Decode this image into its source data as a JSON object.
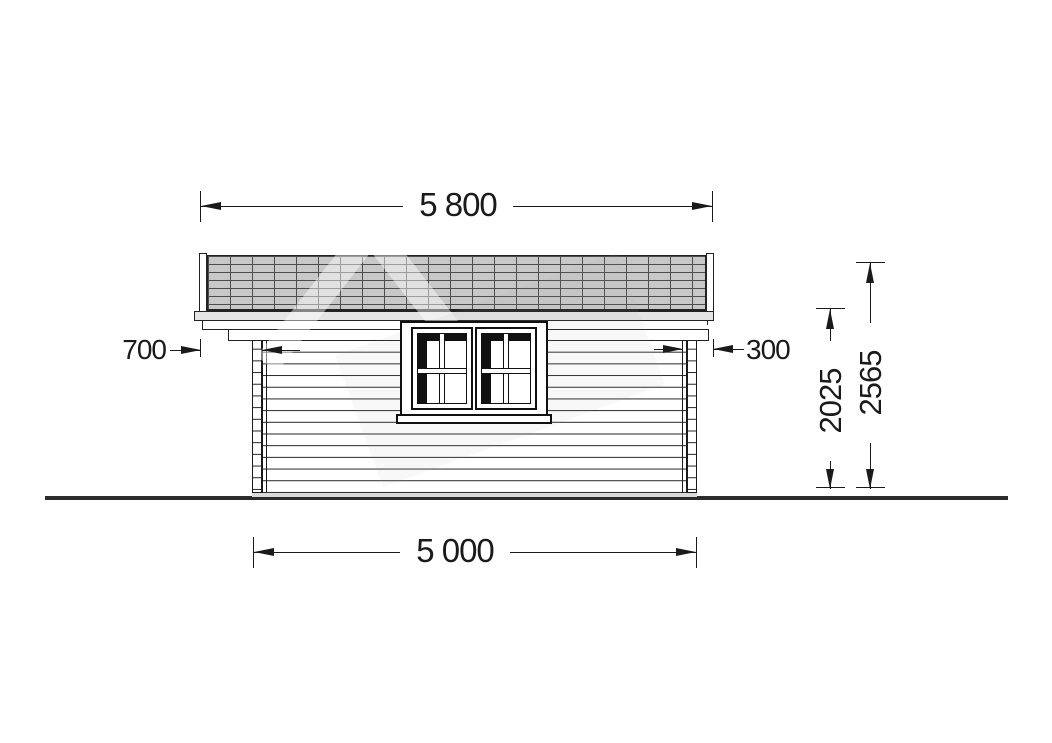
{
  "drawing": {
    "kind": "log-cabin-side-elevation",
    "dimensions": {
      "roof_width_label": "5 800",
      "base_width_label": "5 000",
      "left_overhang_label": "700",
      "right_overhang_label": "300",
      "eave_height_label": "2025",
      "ridge_height_label": "2565"
    },
    "colors": {
      "line": "#1a1a1a",
      "roof_shingle_fill": "#c8c8c8",
      "fascia_fill": "#e4e4e4",
      "foundation_fill": "#d9d9d9",
      "ground_line": "#2b2b2b",
      "glazing_shadow": "#111111",
      "background": "#ffffff"
    }
  }
}
